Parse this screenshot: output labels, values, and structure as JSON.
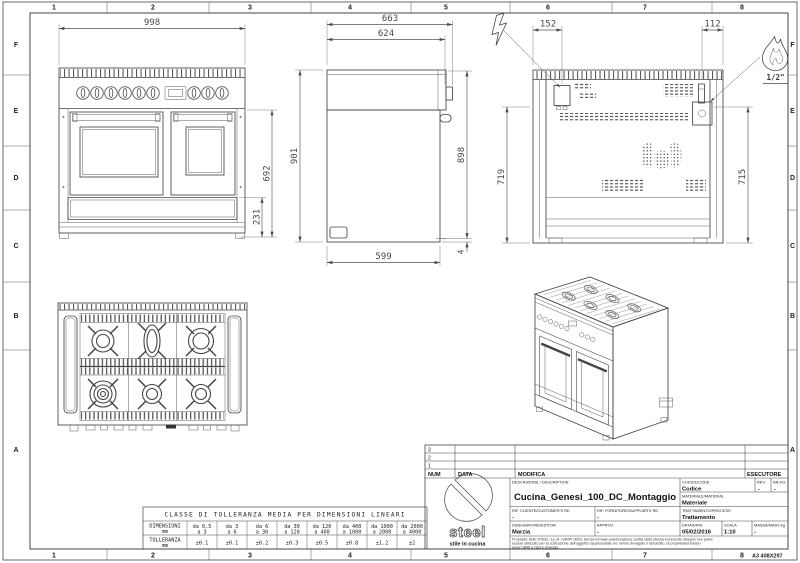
{
  "drawing_frame": {
    "columns": [
      "1",
      "2",
      "3",
      "4",
      "5",
      "6",
      "7",
      "8"
    ],
    "rows": [
      "F",
      "E",
      "D",
      "C",
      "B",
      "A"
    ],
    "sheet_format": "A3 408X297"
  },
  "dimensions": {
    "front": {
      "width": "998",
      "oven_height": "692",
      "drawer_height": "231"
    },
    "side": {
      "depth_total": "663",
      "depth_top": "624",
      "height_left": "901",
      "height_right": "898",
      "depth_base": "599",
      "rear_gap": "4"
    },
    "back": {
      "electric_offset": "152",
      "gas_offset": "112",
      "height_left": "719",
      "height_right": "715",
      "gas_thread": "1/2\""
    }
  },
  "icons": {
    "electric_symbol": "lightning-bolt",
    "gas_symbol": "flame"
  },
  "tolerance_table": {
    "title": "CLASSE DI TOLLERANZA MEDIA PER DIMENSIONI LINEARI",
    "dim_label": "DIMENSIONI",
    "dim_unit": "mm",
    "tol_label": "TOLLERANZA",
    "tol_unit": "mm",
    "range_from": [
      "da 0.5",
      "da 3",
      "da 6",
      "da 30",
      "da 120",
      "da 400",
      "da 1000",
      "da 2000"
    ],
    "range_to": [
      "a 3",
      "a 6",
      "a 30",
      "a 120",
      "a 400",
      "a 1000",
      "a 2000",
      "a 4000"
    ],
    "tolerances": [
      "±0.1",
      "±0.1",
      "±0.2",
      "±0.3",
      "±0.5",
      "±0.8",
      "±1.2",
      "±2"
    ]
  },
  "title_block": {
    "revisions": [
      "3",
      "2",
      "1"
    ],
    "col_num": "NUM",
    "col_data": "DATA",
    "col_modifica": "MODIFICA",
    "col_esecutore": "ESECUTORE",
    "description_label": "DESCRIZIONE / DESCRIPTION",
    "description": "Cucina_Genesi_100_DC_Montaggio",
    "code_label": "CODICE/CODE",
    "code": "Codice",
    "rev_label": "REV.",
    "rev": "-",
    "sheet_no_label": "NR.FG.",
    "sheet_no": "-",
    "material_label": "MATERIALE/MATERIAL",
    "material": "Materiale",
    "customer_ref_label": "RIF. CLIENTE/CUSTOMER'S RE.",
    "customer_ref": "-",
    "supplier_ref_label": "RIF. FORNITORE/SUPPLIER'S RE.",
    "supplier_ref": "-",
    "process_label": "TRATTAMENTO/PROCESS",
    "process": "Trattamento",
    "editor_label": "DISEGNATORE/EDITOR",
    "editor": "Marzia",
    "approv_label": "APPROV.",
    "approv": "-",
    "date_label": "DATA/DATE",
    "date": "05/02/2016",
    "scale_label": "SCALA",
    "scale": "1:10",
    "mass_label": "MASSA/MASS kg",
    "mass": "-",
    "disclaimer_lines": [
      "Proprieta' dello STEEL S.p.A. CARPI (MO). Senza formale autorizzazione scritta della stessa il presente disegno non potra'",
      "essere utilizzato per la costruzione dell'oggetto rappresentato ne' venire divulgato o riprodotto, la proprietaria tutela i",
      "propri diritti a rigore di legge."
    ],
    "logo_text": "steel",
    "logo_tagline": "stile in cucina"
  },
  "colors": {
    "line": "#454545",
    "dim": "#555555",
    "background": "#ffffff"
  }
}
